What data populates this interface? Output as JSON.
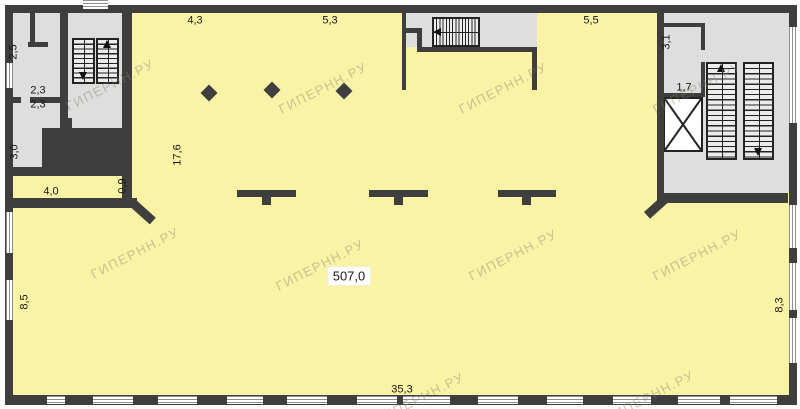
{
  "colors": {
    "wall": "#3e3e3e",
    "hall_floor": "#faf3a6",
    "service_floor": "#dedede",
    "window_frame": "#8f8f8f",
    "label_text": "#181818"
  },
  "watermark": {
    "text": "ГИПЕРНН.РУ"
  },
  "dimensions": {
    "top_left_span": "4,3",
    "top_mid_span": "5,3",
    "top_right_span": "5,5",
    "upper_room": "2,5",
    "mid_room_a": "2,3",
    "mid_room_b": "2,3",
    "lower_room": "3,0",
    "corridor_width": "4,0",
    "passage_width": "0,9",
    "upper_hall_depth": "17,6",
    "right_room_a": "3,1",
    "right_room_b": "1,7",
    "hall_area": "507,0",
    "left_wall_span": "8,5",
    "right_wall_span": "8,3",
    "bottom_wall_span": "35,3"
  }
}
